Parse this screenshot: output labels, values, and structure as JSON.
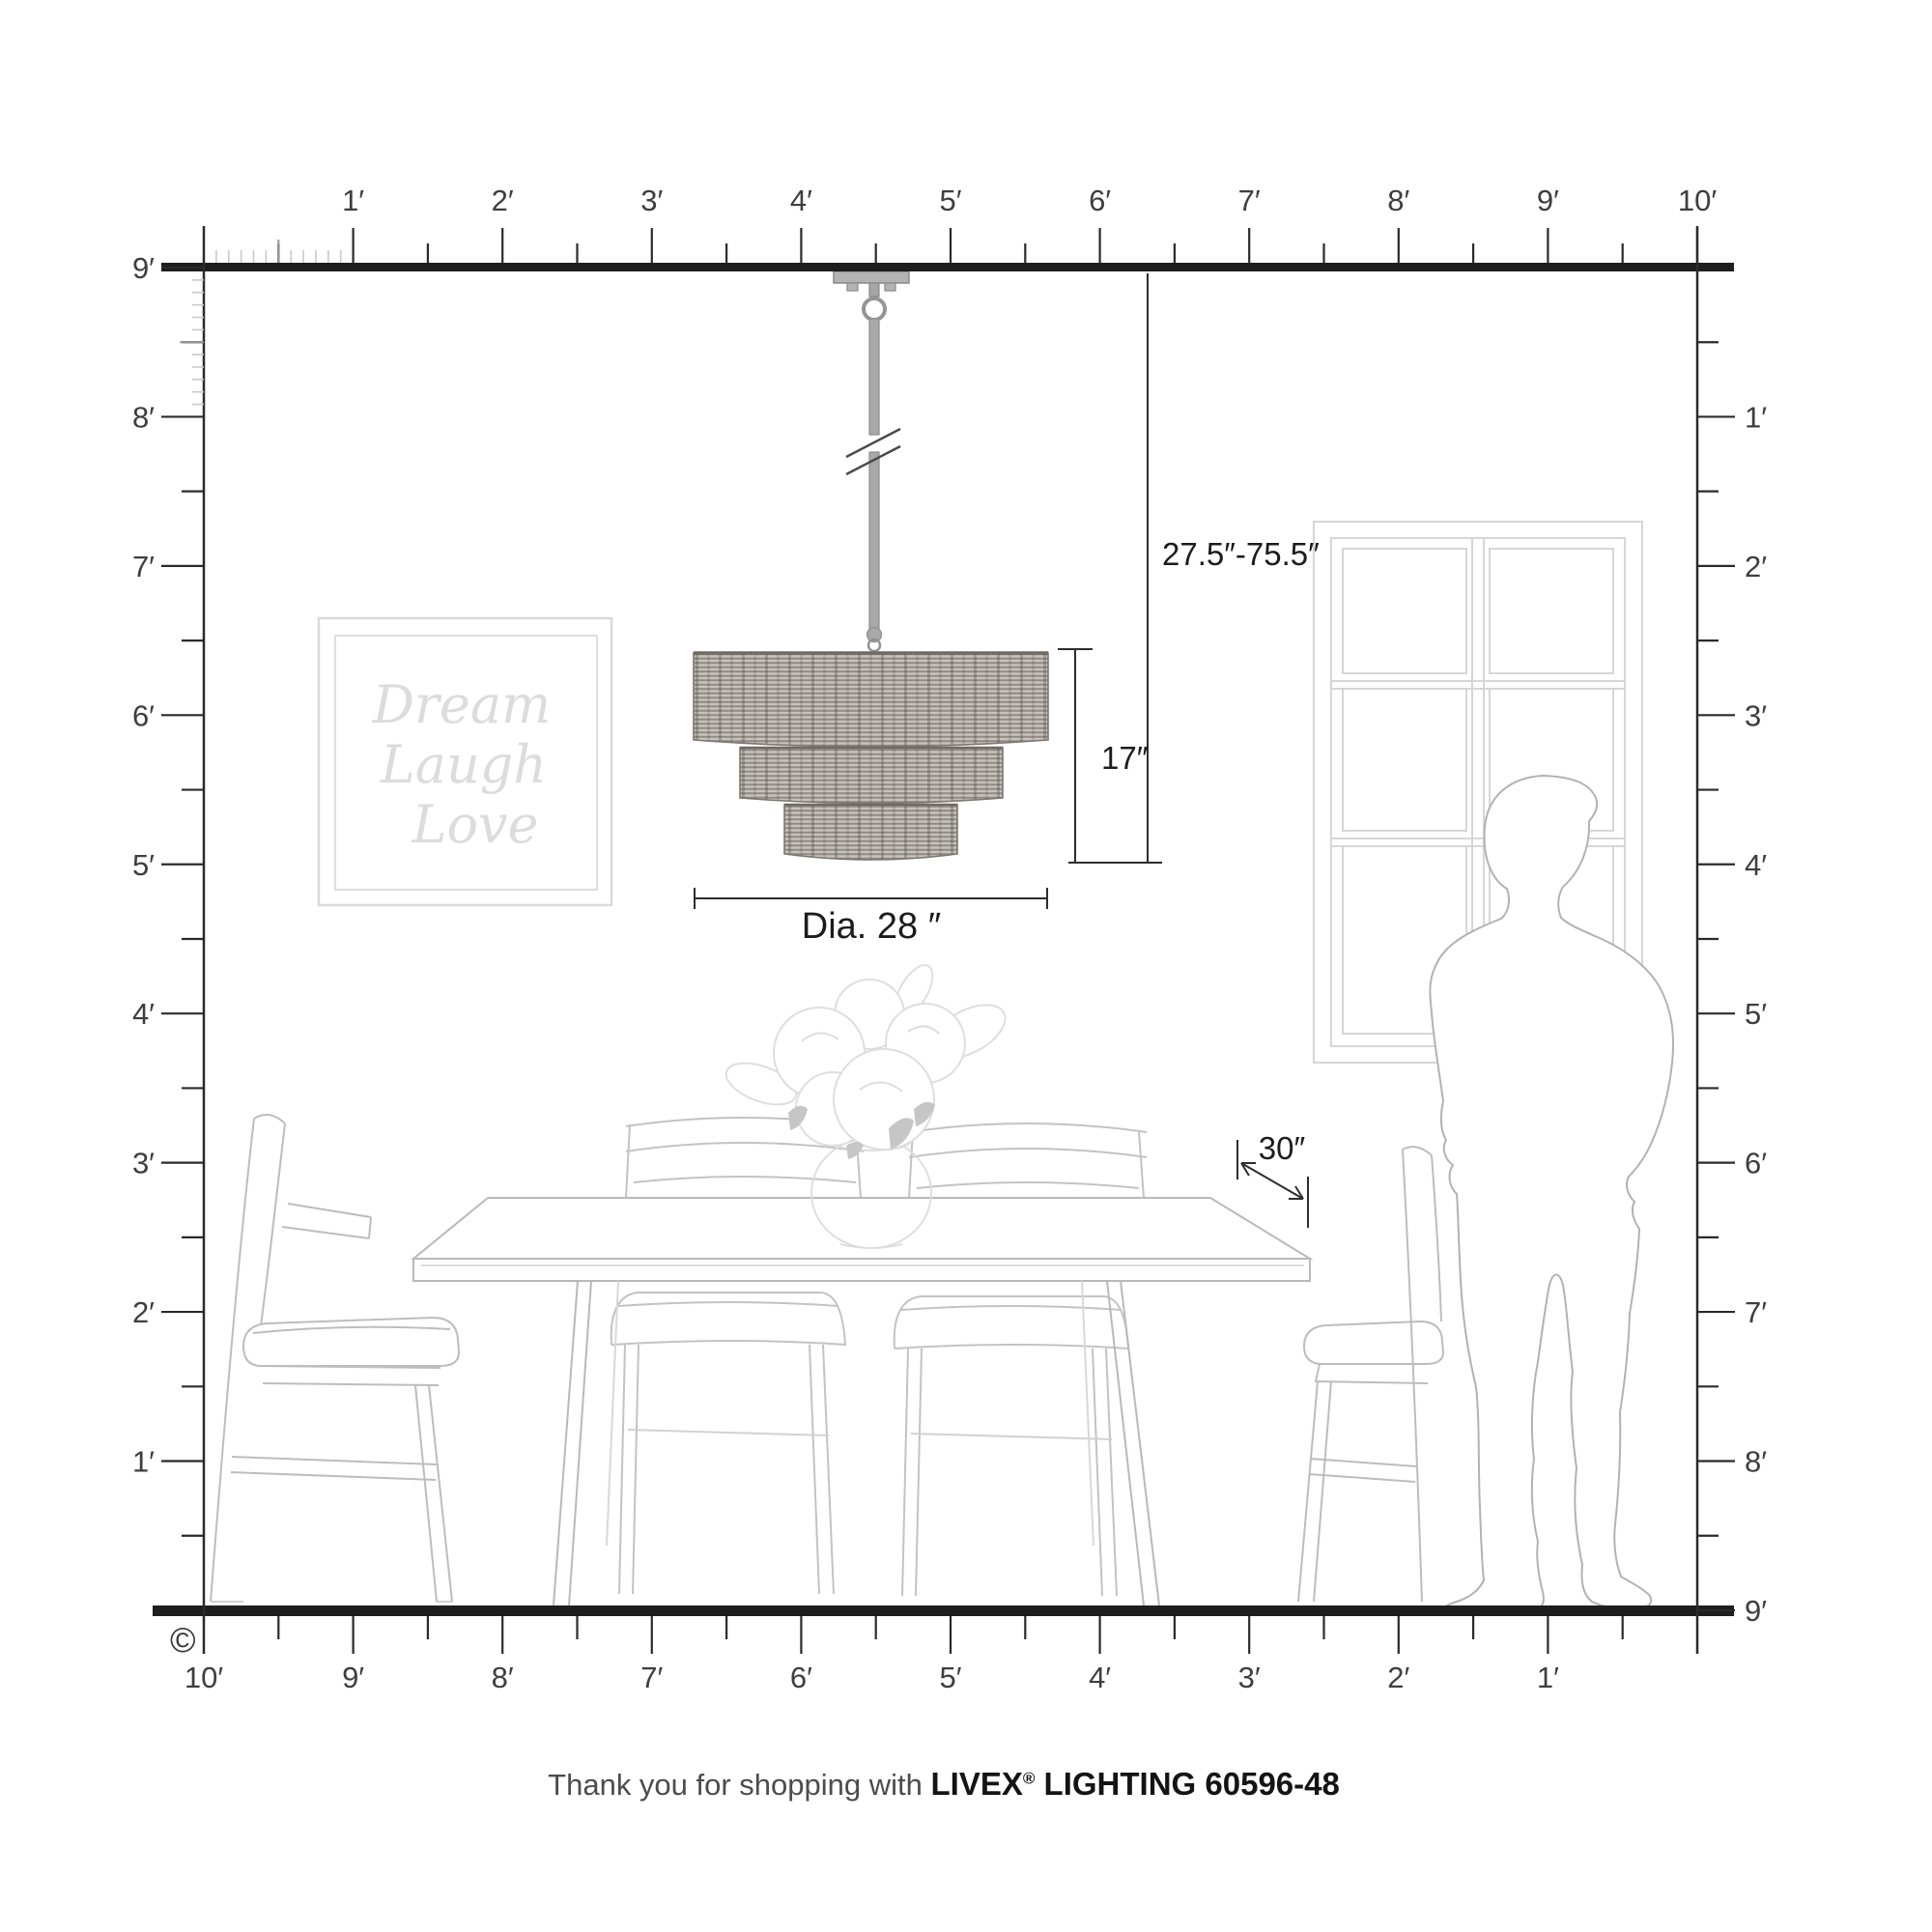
{
  "product": {
    "brand": "LIVEX",
    "line": "LIGHTING",
    "model": "60596-48"
  },
  "annotations": {
    "hang_range": "27.5″-75.5″",
    "shade_height": "17″",
    "diameter": "Dia. 28 ″",
    "table_clearance": "30″"
  },
  "wall_art": {
    "line1": "Dream",
    "line2": "Laugh",
    "line3": "Love"
  },
  "copyright_symbol": "©",
  "footer": {
    "prefix": "Thank you for shopping with ",
    "brand": "LIVEX",
    "registered": "®",
    "suffix": " LIGHTING 60596-48"
  },
  "rulers": {
    "top_labels": [
      "1′",
      "2′",
      "3′",
      "4′",
      "5′",
      "6′",
      "7′",
      "8′",
      "9′",
      "10′"
    ],
    "left_labels": [
      "9′",
      "8′",
      "7′",
      "6′",
      "5′",
      "4′",
      "3′",
      "2′",
      "1′"
    ],
    "right_labels": [
      "1′",
      "2′",
      "3′",
      "4′",
      "5′",
      "6′",
      "7′",
      "8′",
      "9′"
    ],
    "bottom_labels": [
      "10′",
      "9′",
      "8′",
      "7′",
      "6′",
      "5′",
      "4′",
      "3′",
      "2′",
      "1′"
    ]
  },
  "colors": {
    "ruler_dark": "#1e1e1e",
    "tick_dark": "#2a2a2a",
    "tick_inch": "#c9c9c9",
    "tick_half_inch_zone": "#999999",
    "furniture_line": "#bdbdbd",
    "faint_line": "#d6d6d6",
    "person_line": "#b2b2b2",
    "dimension_line": "#2d2d2d",
    "shade_base": "#c7c2bc",
    "shade_weave": "#8f8a84",
    "metal": "#a5a5a5"
  }
}
